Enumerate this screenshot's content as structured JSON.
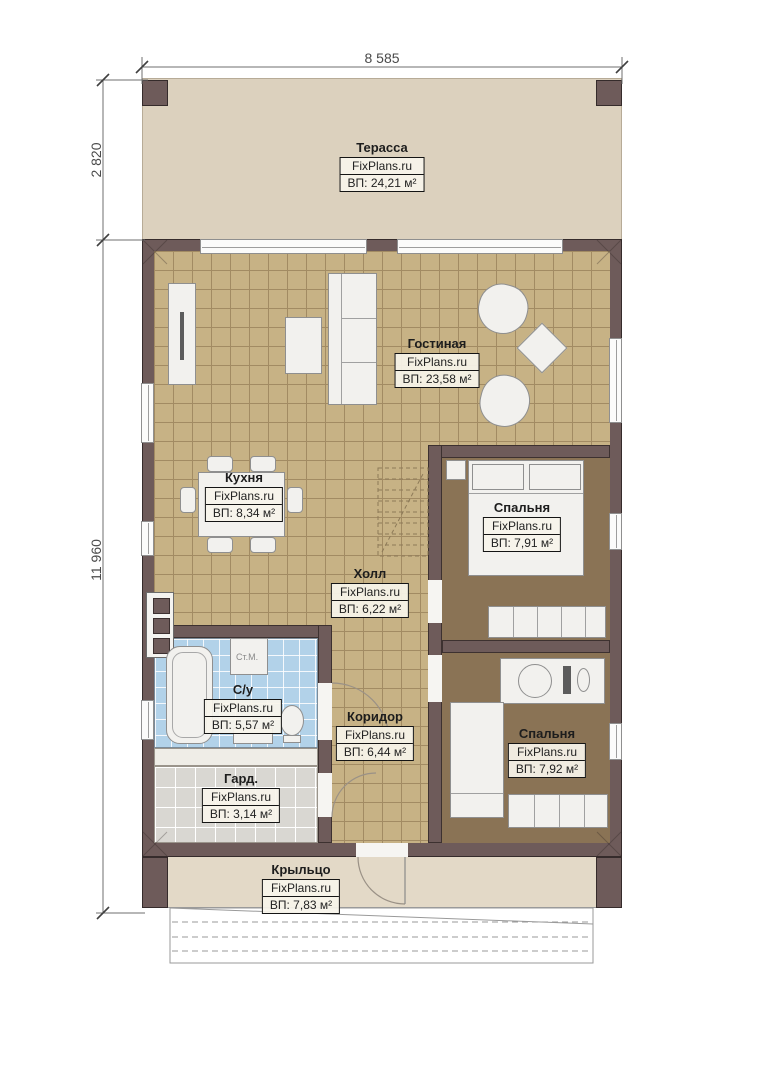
{
  "page": {
    "type": "architectural-floor-plan",
    "site": "FixPlans.ru"
  },
  "brand": "FixPlans.ru",
  "dimensions": {
    "width_top": "8 585",
    "terrace_depth": "2 820",
    "house_depth": "11 960"
  },
  "rooms": [
    {
      "id": "terrace",
      "name": "Терасса",
      "area": "ВП: 24,21 м²"
    },
    {
      "id": "living",
      "name": "Гостиная",
      "area": "ВП: 23,58 м²"
    },
    {
      "id": "kitchen",
      "name": "Кухня",
      "area": "ВП: 8,34 м²"
    },
    {
      "id": "bedroom1",
      "name": "Спальня",
      "area": "ВП: 7,91 м²"
    },
    {
      "id": "hall",
      "name": "Холл",
      "area": "ВП: 6,22 м²"
    },
    {
      "id": "bathroom",
      "name": "С/у",
      "area": "ВП: 5,57 м²"
    },
    {
      "id": "corridor",
      "name": "Коридор",
      "area": "ВП: 6,44 м²"
    },
    {
      "id": "bedroom2",
      "name": "Спальня",
      "area": "ВП: 7,92 м²"
    },
    {
      "id": "wardrobe",
      "name": "Гард.",
      "area": "ВП: 3,14 м²"
    },
    {
      "id": "porch",
      "name": "Крыльцо",
      "area": "ВП: 7,83 м²"
    }
  ],
  "labels": {
    "washing_machine": "Ст.М."
  },
  "colors": {
    "wall": "#6e5b5a",
    "wall_outline": "#352b2b",
    "tile_floor": "#c7b285",
    "tile_grid": "#a28b63",
    "bedroom_floor": "#8a7355",
    "bathroom_floor": "#b2d2e9",
    "wardrobe_floor": "#d9d7d2",
    "terrace_floor": "#dcd1be",
    "porch_floor": "#e3d9c7",
    "furniture": "#f2f1ee",
    "furniture_outline": "#8f8f8f",
    "label_border": "#141414"
  }
}
